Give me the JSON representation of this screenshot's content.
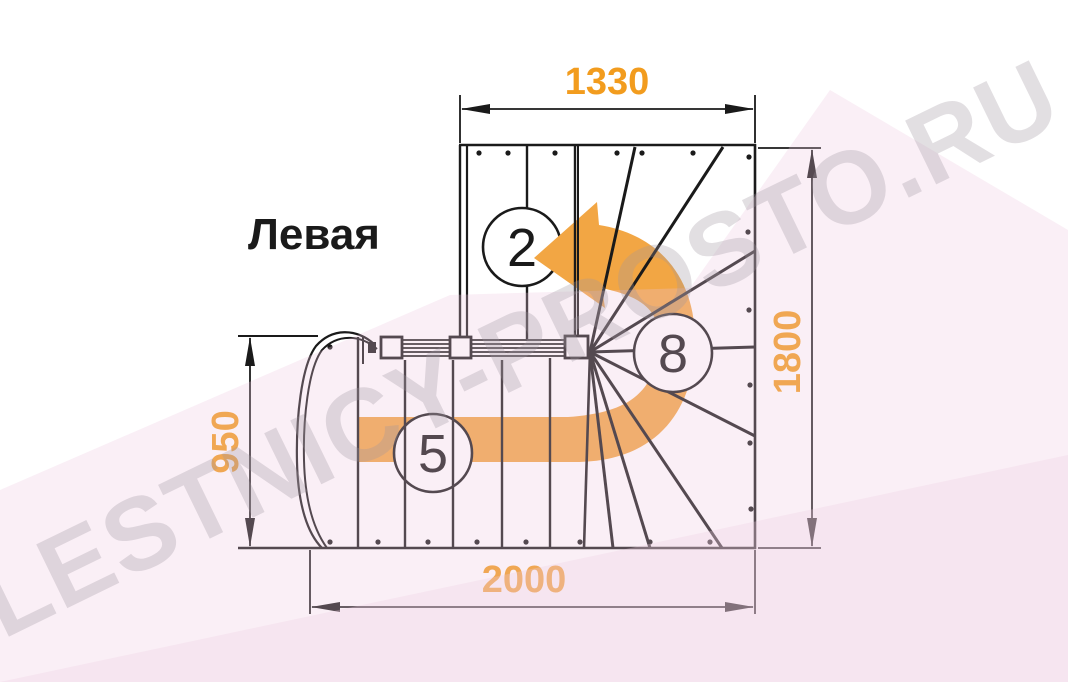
{
  "title": "Левая",
  "dimensions": {
    "top": "1330",
    "right": "1800",
    "left": "950",
    "bottom": "2000"
  },
  "steps": {
    "upper_flight": "2",
    "lower_flight": "5",
    "winder": "8"
  },
  "watermark": "LESTNICY-PROSTO.RU",
  "colors": {
    "dimension": "#F29C1E",
    "arrow": "#F2A644",
    "line": "#1A1A1A",
    "background_tint": "#F5EDF2"
  }
}
